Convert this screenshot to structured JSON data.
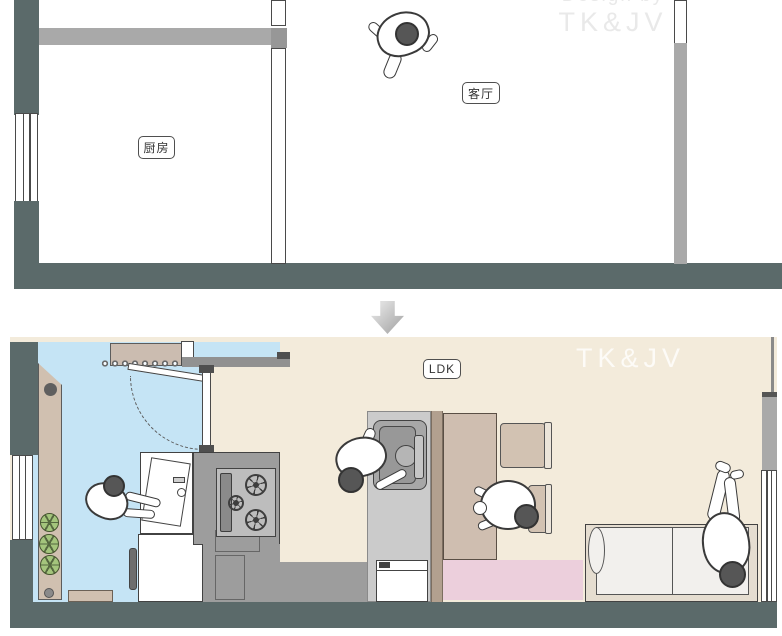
{
  "before_plan": {
    "room_labels": [
      {
        "text": "厨房"
      },
      {
        "text": "客厅"
      }
    ],
    "watermark": {
      "line1": "Design by",
      "line2": "TK&JV"
    }
  },
  "after_plan": {
    "room_label": "LDK",
    "watermark": "TK&JV"
  },
  "colors": {
    "wall_dark_teal": "#5b6a6a",
    "wall_gray": "#a9a9a9",
    "kitchen_floor_blue": "#c5e4f5",
    "ldk_floor_cream": "#f3ebdb",
    "furniture_beige": "#d0c0b0",
    "partition_tan": "#b2a08f",
    "rug_pink": "#eccfdc",
    "counter_gray": "#9d9d9d",
    "stove_gray": "#bdbdbd",
    "plant_green": "#a4c57c",
    "person_head_gray": "#565656"
  }
}
